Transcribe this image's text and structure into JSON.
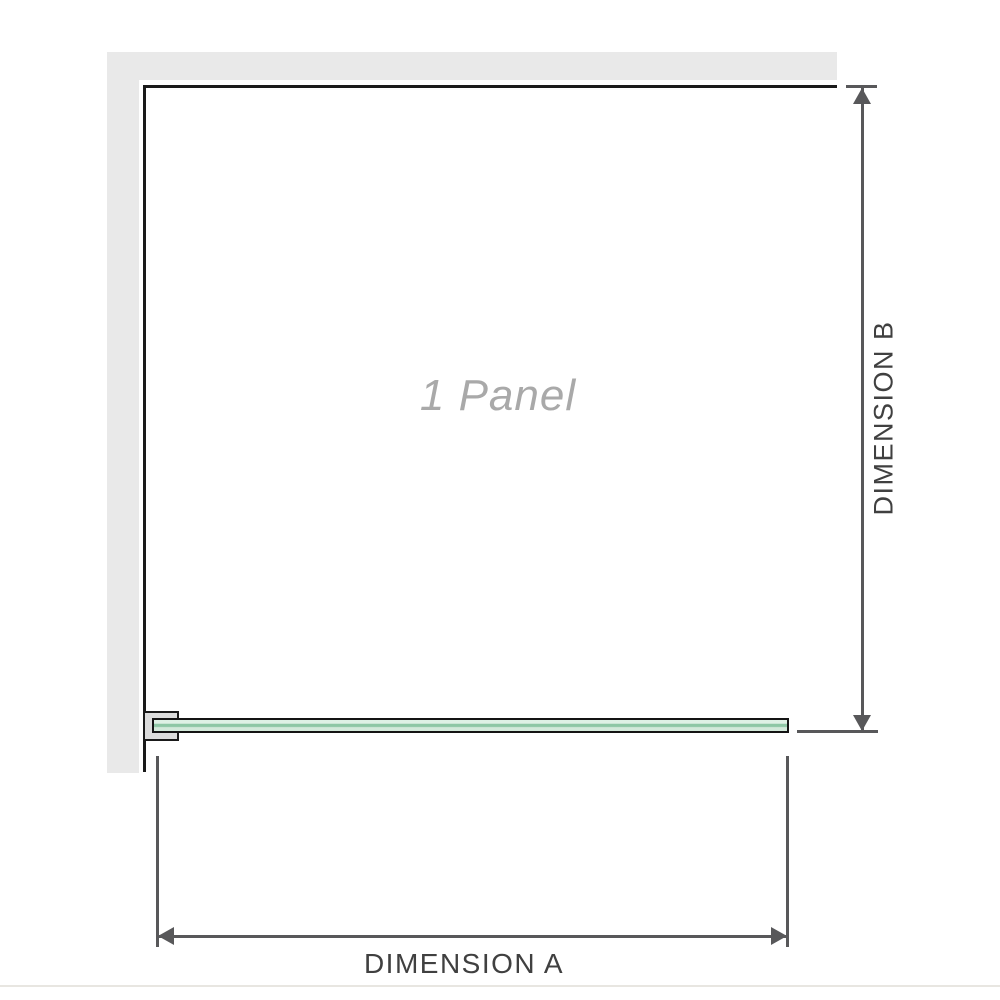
{
  "diagram": {
    "title": "1 Panel",
    "dimension_a": {
      "label": "DIMENSION A"
    },
    "dimension_b": {
      "label": "DIMENSION B"
    }
  },
  "colors": {
    "background": "#ffffff",
    "wall": "#e9e9e9",
    "frame": "#1a1a1a",
    "dimension_line": "#58585a",
    "dimension_text": "#404040",
    "panel_text": "#a9a9a9",
    "glass_outline": "#141414",
    "glass_light": "#dff1e5",
    "glass_stripe": "#8ec7a5",
    "glass_light2": "#d3e9da",
    "bracket_fill": "#dcdcdc",
    "divider": "#e8e6e1"
  }
}
